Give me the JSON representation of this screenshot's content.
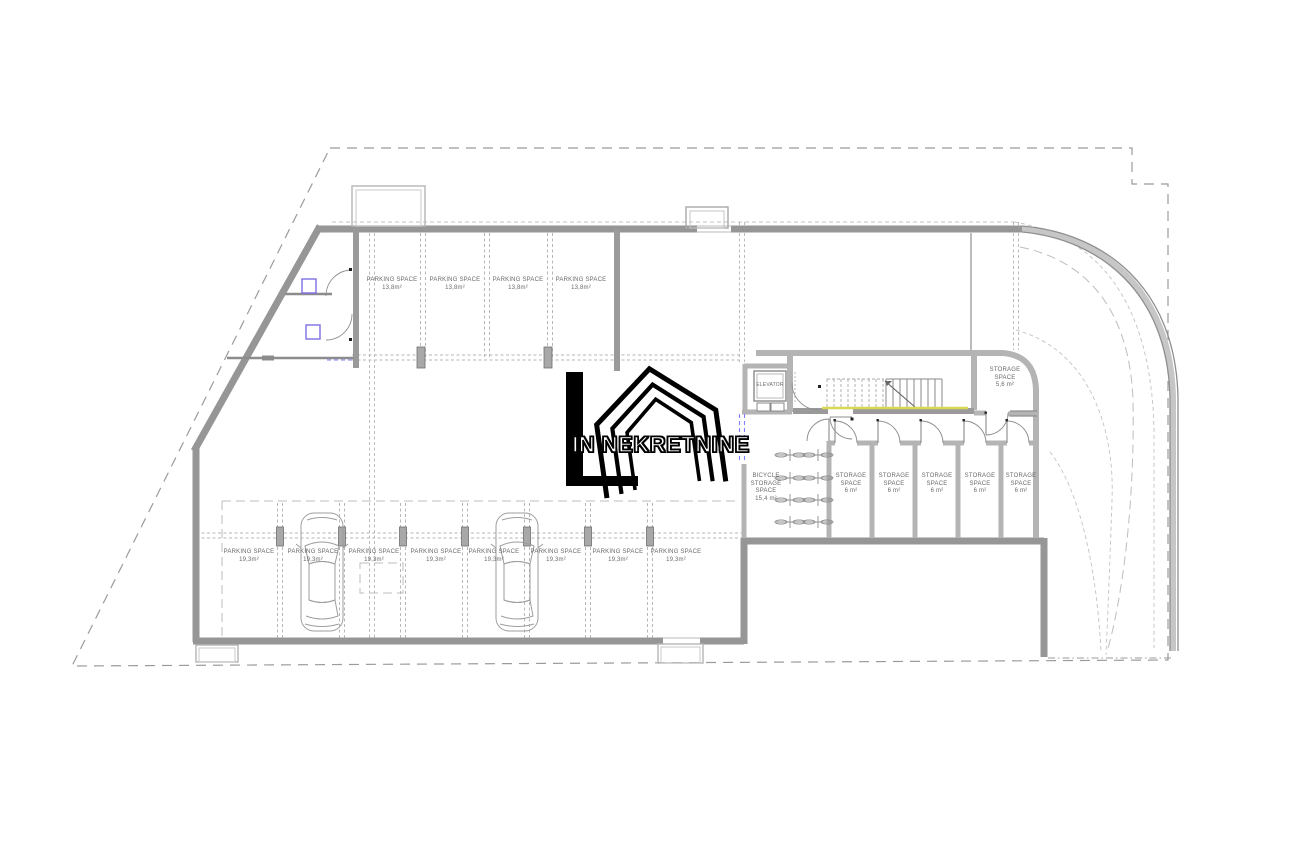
{
  "watermark": {
    "text": "IN NEKRETNINE"
  },
  "rooms": {
    "elevator": {
      "label": "ELEVATOR"
    },
    "bicycle_storage": {
      "label": "BICYCLE STORAGE SPACE",
      "area": "15,4 m²"
    },
    "storage_corner": {
      "label": "STORAGE SPACE",
      "area": "5,6 m²"
    },
    "storage_unit": {
      "label": "STORAGE SPACE",
      "area": "6 m²",
      "count": 5
    }
  },
  "parking": {
    "top_space": {
      "label": "PARKING SPACE",
      "area": "13,8m²",
      "count": 4
    },
    "bottom_space": {
      "label": "PARKING SPACE",
      "area": "19,3m²",
      "count": 8
    }
  },
  "colors": {
    "wall_gray": "#969696",
    "thermal_line_blue": "#7f7fff",
    "equipment_purple": "#7d6fe0",
    "stair_edge_yellow": "#d8d855"
  }
}
